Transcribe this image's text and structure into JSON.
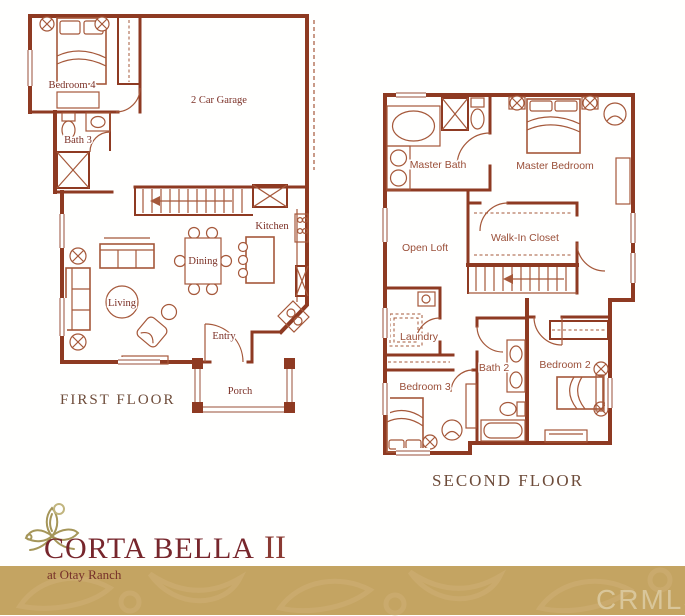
{
  "first_floor": {
    "title": "FIRST FLOOR",
    "rooms": {
      "bedroom4": "Bedroom 4",
      "bath3": "Bath 3",
      "garage": "2 Car Garage",
      "kitchen": "Kitchen",
      "dining": "Dining",
      "living": "Living",
      "entry": "Entry",
      "porch": "Porch"
    }
  },
  "second_floor": {
    "title": "SECOND FLOOR",
    "rooms": {
      "master_bath": "Master Bath",
      "master_bedroom": "Master Bedroom",
      "open_loft": "Open Loft",
      "walk_in_closet": "Walk-In Closet",
      "laundry": "Laundry",
      "bath2": "Bath 2",
      "bedroom3": "Bedroom 3",
      "bedroom2": "Bedroom 2"
    }
  },
  "branding": {
    "community_name": "CORTA BELLA",
    "series_numeral": "II",
    "tagline": "at Otay Ranch"
  },
  "watermark": "CRMLS",
  "colors": {
    "wall_brick": "#8e3a22",
    "fixture_line": "#a5583a",
    "floorplan_label": "#7b3025",
    "second_floor_label": "#9a4f38",
    "floor_title": "#6e4c3a",
    "logo_maroon": "#77262c",
    "logo_olive": "#a59659",
    "band_gold": "#c4a462",
    "watermark_text": "#d9c69a"
  }
}
